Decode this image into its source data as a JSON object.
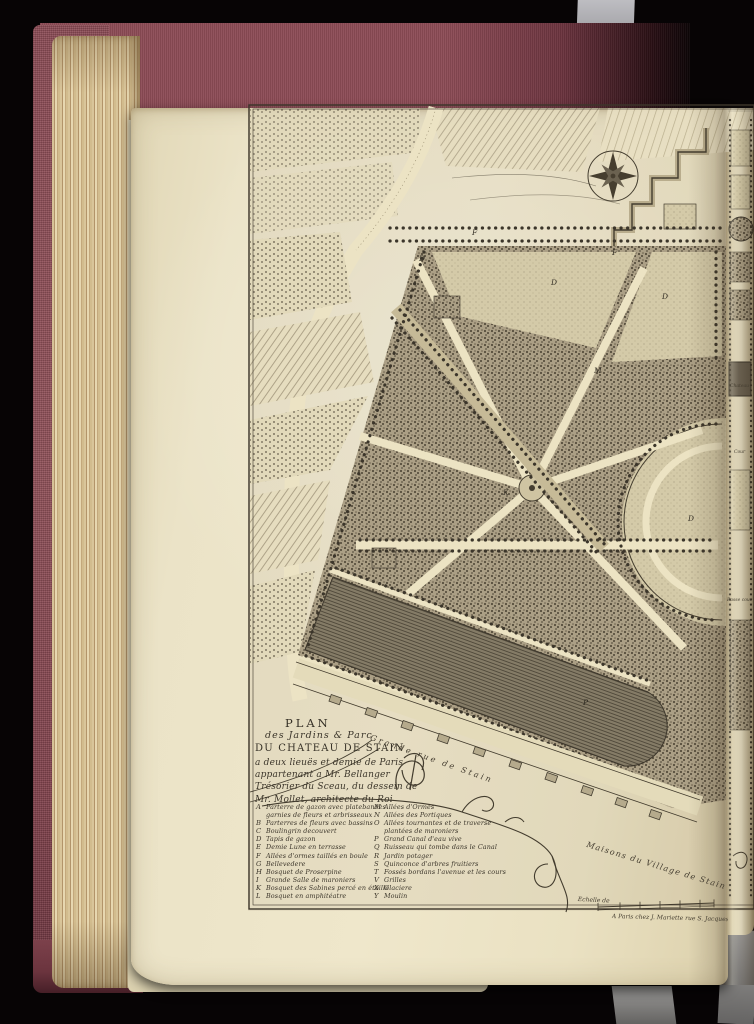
{
  "scene": {
    "background_color": "#070405",
    "book_cover_color": "#8e4d57",
    "page_color": "#ece4c8",
    "page_edge_color": "#c9b286",
    "strap_color": "#a7a7ab",
    "ink_color": "#3b352a"
  },
  "plate": {
    "title_block": {
      "line1": "PLAN",
      "line2": "des Jardins & Parc",
      "line3": "DU CHATEAU DE STAIN",
      "line4": "a deux lieuës et demie de Paris",
      "line5": "appartenant a Mr. Bellanger",
      "line6": "Trésorier du Sceau, du dessein de",
      "line7": "Mr. Mollet, architecte du Roi"
    },
    "legend_left": [
      {
        "key": "A",
        "text": "Parterre de gazon avec platebandes"
      },
      {
        "key": "",
        "text": "garnies de fleurs et arbrisseaux"
      },
      {
        "key": "B",
        "text": "Parterres de fleurs avec bassins"
      },
      {
        "key": "C",
        "text": "Boulingrin decouvert"
      },
      {
        "key": "D",
        "text": "Tapis de gazon"
      },
      {
        "key": "E",
        "text": "Demie Lune en terrasse"
      },
      {
        "key": "F",
        "text": "Allées d'ormes taillés en boule"
      },
      {
        "key": "G",
        "text": "Bellevedere"
      },
      {
        "key": "H",
        "text": "Bosquet de Proserpine"
      },
      {
        "key": "I",
        "text": "Grande Salle de maroniers"
      },
      {
        "key": "K",
        "text": "Bosquet des Sabines percé en étoille"
      },
      {
        "key": "L",
        "text": "Bosquet en amphitéatre"
      }
    ],
    "legend_right": [
      {
        "key": "M",
        "text": "Allées d'Ormes"
      },
      {
        "key": "N",
        "text": "Allées des Portiques"
      },
      {
        "key": "O",
        "text": "Allées tournantes et de traverse"
      },
      {
        "key": "",
        "text": "plantées de maroniers"
      },
      {
        "key": "P",
        "text": "Grand Canal d'eau vive"
      },
      {
        "key": "Q",
        "text": "Ruisseau qui tombe dans le Canal"
      },
      {
        "key": "R",
        "text": "Jardin potager"
      },
      {
        "key": "S",
        "text": "Quinconce d'arbres fruitiers"
      },
      {
        "key": "T",
        "text": "Fossés bordans l'avenue et les cours"
      },
      {
        "key": "V",
        "text": "Grilles"
      },
      {
        "key": "X",
        "text": "Glaciere"
      },
      {
        "key": "Y",
        "text": "Moulin"
      }
    ],
    "labels": {
      "grande_rue": "Grande rue de Stain",
      "maisons_village": "Maisons du Village de Stain",
      "echelle": "Echelle de",
      "imprint": "A Paris chez J. Mariette rue S. Jacques",
      "chateau": "Chateau",
      "cour": "Cour",
      "basse_cour": "Basse cour"
    },
    "map_letters": [
      "F",
      "D",
      "D",
      "F",
      "D",
      "K",
      "D",
      "P",
      "M"
    ]
  },
  "annotations": {
    "pencil_number": "1921-6-322"
  }
}
